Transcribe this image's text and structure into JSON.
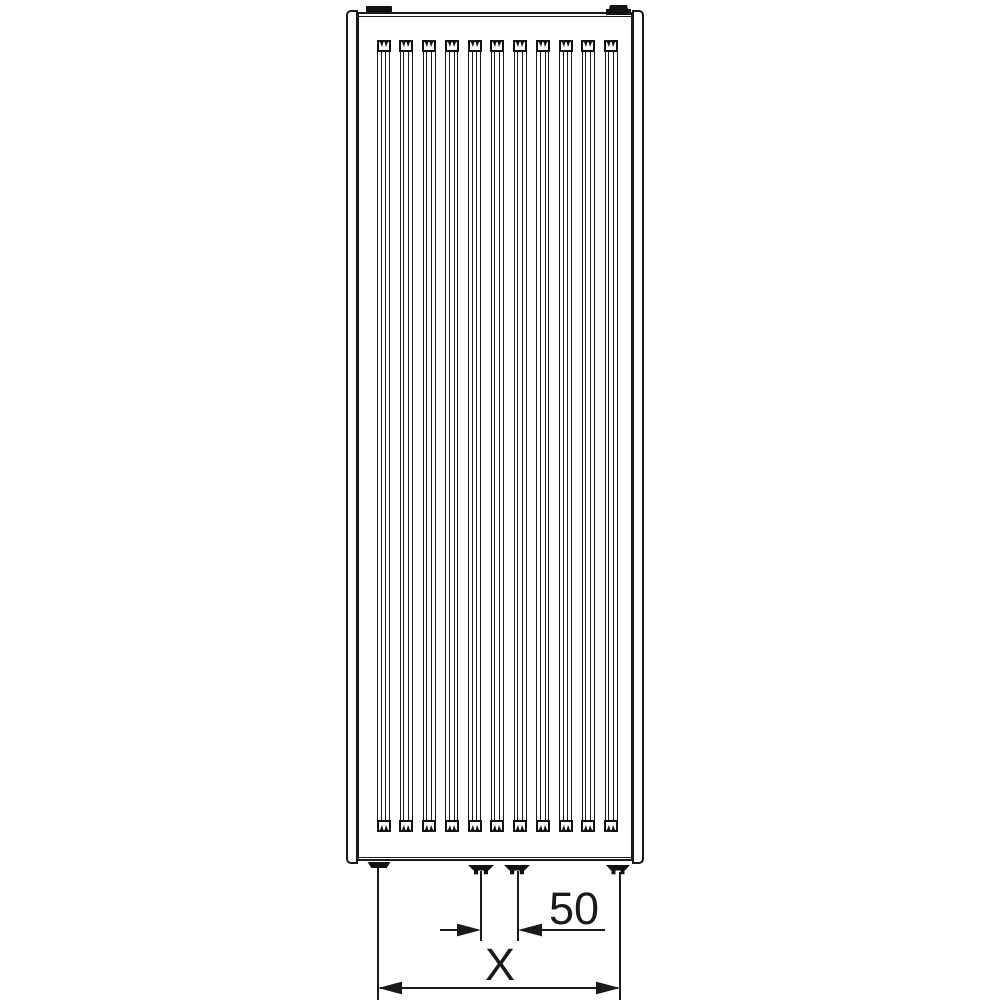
{
  "diagram": {
    "subject": "vertical-panel-radiator-front-view",
    "channel_count": 11,
    "colors": {
      "line": "#1a1a1a",
      "fitting_black": "#111111",
      "background": "#ffffff"
    },
    "dimension_labels": {
      "connection_spacing": "50",
      "overall_width": "X"
    }
  }
}
